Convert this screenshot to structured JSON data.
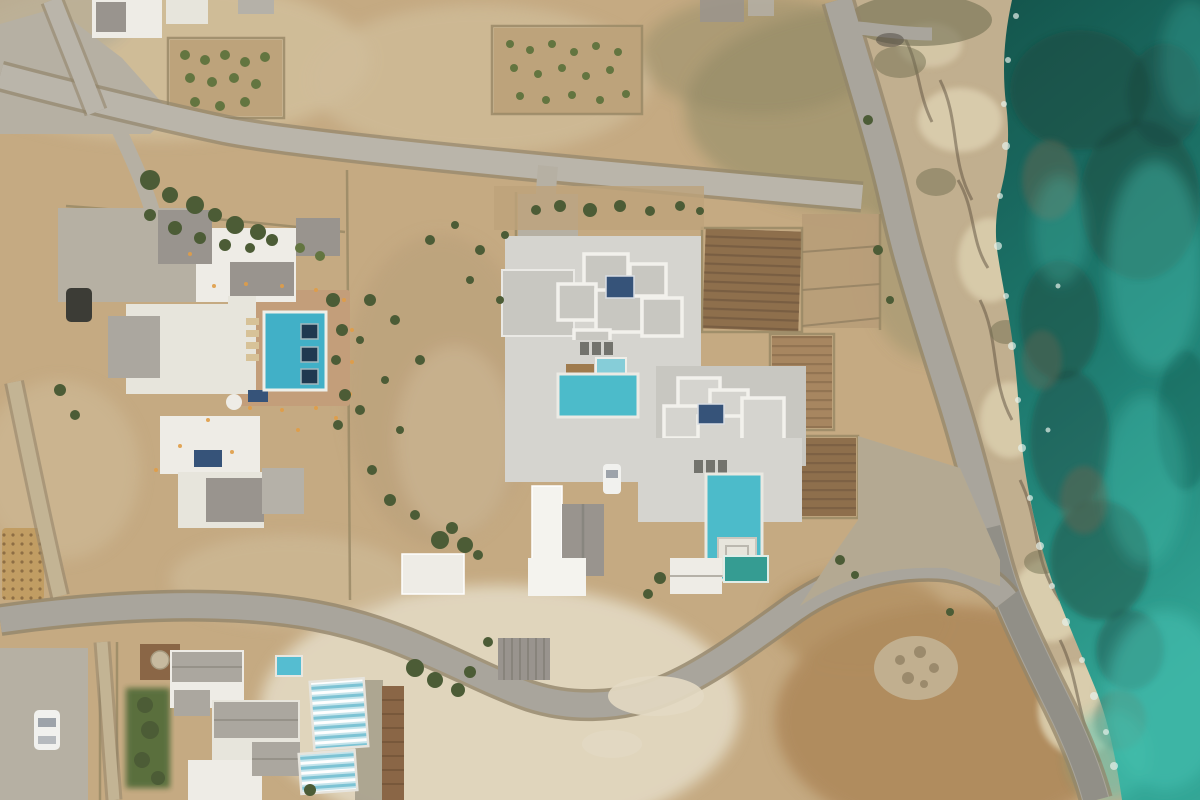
{
  "scene": {
    "description": "Top-down aerial drone photograph of a Cycladic coastal estate: three white villa complexes with swimming pools, winding roads, dry scrubland, terraced garden plots, a rocky shoreline and turquoise sea along the right edge",
    "view": "top-down aerial photo",
    "width_px": 1200,
    "height_px": 800
  },
  "colors": {
    "terrain_base": "#c4a87e",
    "terrain_pale": "#cfbb97",
    "terrain_light": "#e3d9c2",
    "terrain_brown": "#ad8757",
    "terrain_rocky": "#b5ab94",
    "scrub_olive": "#8c865f",
    "veg_dark": "#45562f",
    "veg_mid": "#5d7039",
    "veg_light": "#74854a",
    "sea_deep": "#0b4f46",
    "sea_mid": "#15766a",
    "sea_bright": "#2ba493",
    "sea_light": "#3fc0ae",
    "sea_rock": "#123f35",
    "sea_rock_brown": "#5c5f49",
    "foam": "#e6f2ec",
    "shore_tan": "#c0ad8b",
    "shore_pale": "#dccfae",
    "shore_dark": "#584a38",
    "shore_moss": "#6e6b4c",
    "road_light": "#b8b3a8",
    "road_mid": "#a7a399",
    "road_dark": "#8c8981",
    "road_casing": "#8f8166",
    "gravel": "#b2a78f",
    "apron": "#b4aea0",
    "lane_tan": "#c2b291",
    "wall": "#94835f",
    "white_bldg": "#efede6",
    "white_bright": "#f5f4ef",
    "white_soft": "#e7e5dc",
    "roof_gray": "#96918a",
    "roof_gray_light": "#b3afa6",
    "roof_gable": "#a9a59c",
    "terrace": "#d5d4ce",
    "terrace_dark": "#c7c6c0",
    "roof_trim": "#f3f2ed",
    "patio_terracotta": "#c29b76",
    "deck_wood": "#9c7748",
    "boardwalk": "#86613f",
    "pool_turquoise": "#46b9c9",
    "pool_deep": "#3aaec6",
    "pool_small": "#4fbcd0",
    "pool_teal": "#2d998f",
    "pool_lane_light": "#c3e4ec",
    "pool_lane_stripe": "#79c2d4",
    "pool_bed_dark": "#17324a",
    "jacuzzi": "#82ccd8",
    "solar_panel": "#2f4d74",
    "plot_brown": "#8a6a46",
    "plot_light": "#a5825a",
    "plot_tan": "#b69a74",
    "grove_tan": "#bca077",
    "gold_paving": "#c09a5e",
    "car_dark": "#35352f",
    "car_white": "#f2f2ef",
    "car_glass": "#9aa0a8",
    "light_warm": "#e09a40",
    "stone": "#c6b89c",
    "lawn": "#46632f"
  },
  "objects": {
    "sea": {
      "label": "sea",
      "tones": [
        "#0b4f46",
        "#2ba493",
        "#3fc0ae"
      ],
      "features": [
        "submerged reef rocks",
        "white surf foam along shoreline"
      ]
    },
    "shoreline": {
      "label": "rocky-shoreline",
      "tone": "#c0ad8b"
    },
    "roads": [
      {
        "label": "upper-access-road",
        "path": "from top-left corner diagonally to coastal road"
      },
      {
        "label": "coastal-road",
        "path": "from top edge down along the shoreline to bottom-right"
      },
      {
        "label": "lower-winding-road",
        "path": "from left edge, S-curve past the villas, merges with coastal road"
      },
      {
        "label": "west-driveway",
        "path": "short diagonal lane on the left edge"
      }
    ],
    "villas": [
      {
        "label": "west-villa-complex",
        "pools": [
          "rectangular turquoise pool with three dark in-pool daybeds"
        ],
        "details": [
          "terracotta pool patio",
          "warm path lights",
          "dark parked car",
          "rooftop solar panels"
        ]
      },
      {
        "label": "central-villa-complex",
        "pools": [
          "terrace pool with jacuzzi",
          "long infinity pool with white square platform"
        ],
        "details": [
          "white-rimmed flat roofs",
          "blue solar panels",
          "white parked car",
          "terraced garden plots"
        ]
      },
      {
        "label": "southwest-villa-complex",
        "pools": [
          "small plunge pool",
          "two striped lap pools",
          "dark teal pool"
        ],
        "details": [
          "gray gable roofs",
          "wooden boardwalk",
          "lawn garden",
          "white parked car"
        ]
      }
    ],
    "cars": [
      {
        "color": "dark",
        "location": "west villa courtyard"
      },
      {
        "color": "white",
        "location": "central villa driveway"
      },
      {
        "color": "white",
        "location": "southwest parking apron"
      }
    ],
    "garden_plots": 4,
    "rock_pile": {
      "label": "stone-pile",
      "location": "bottom-right dirt field"
    }
  }
}
